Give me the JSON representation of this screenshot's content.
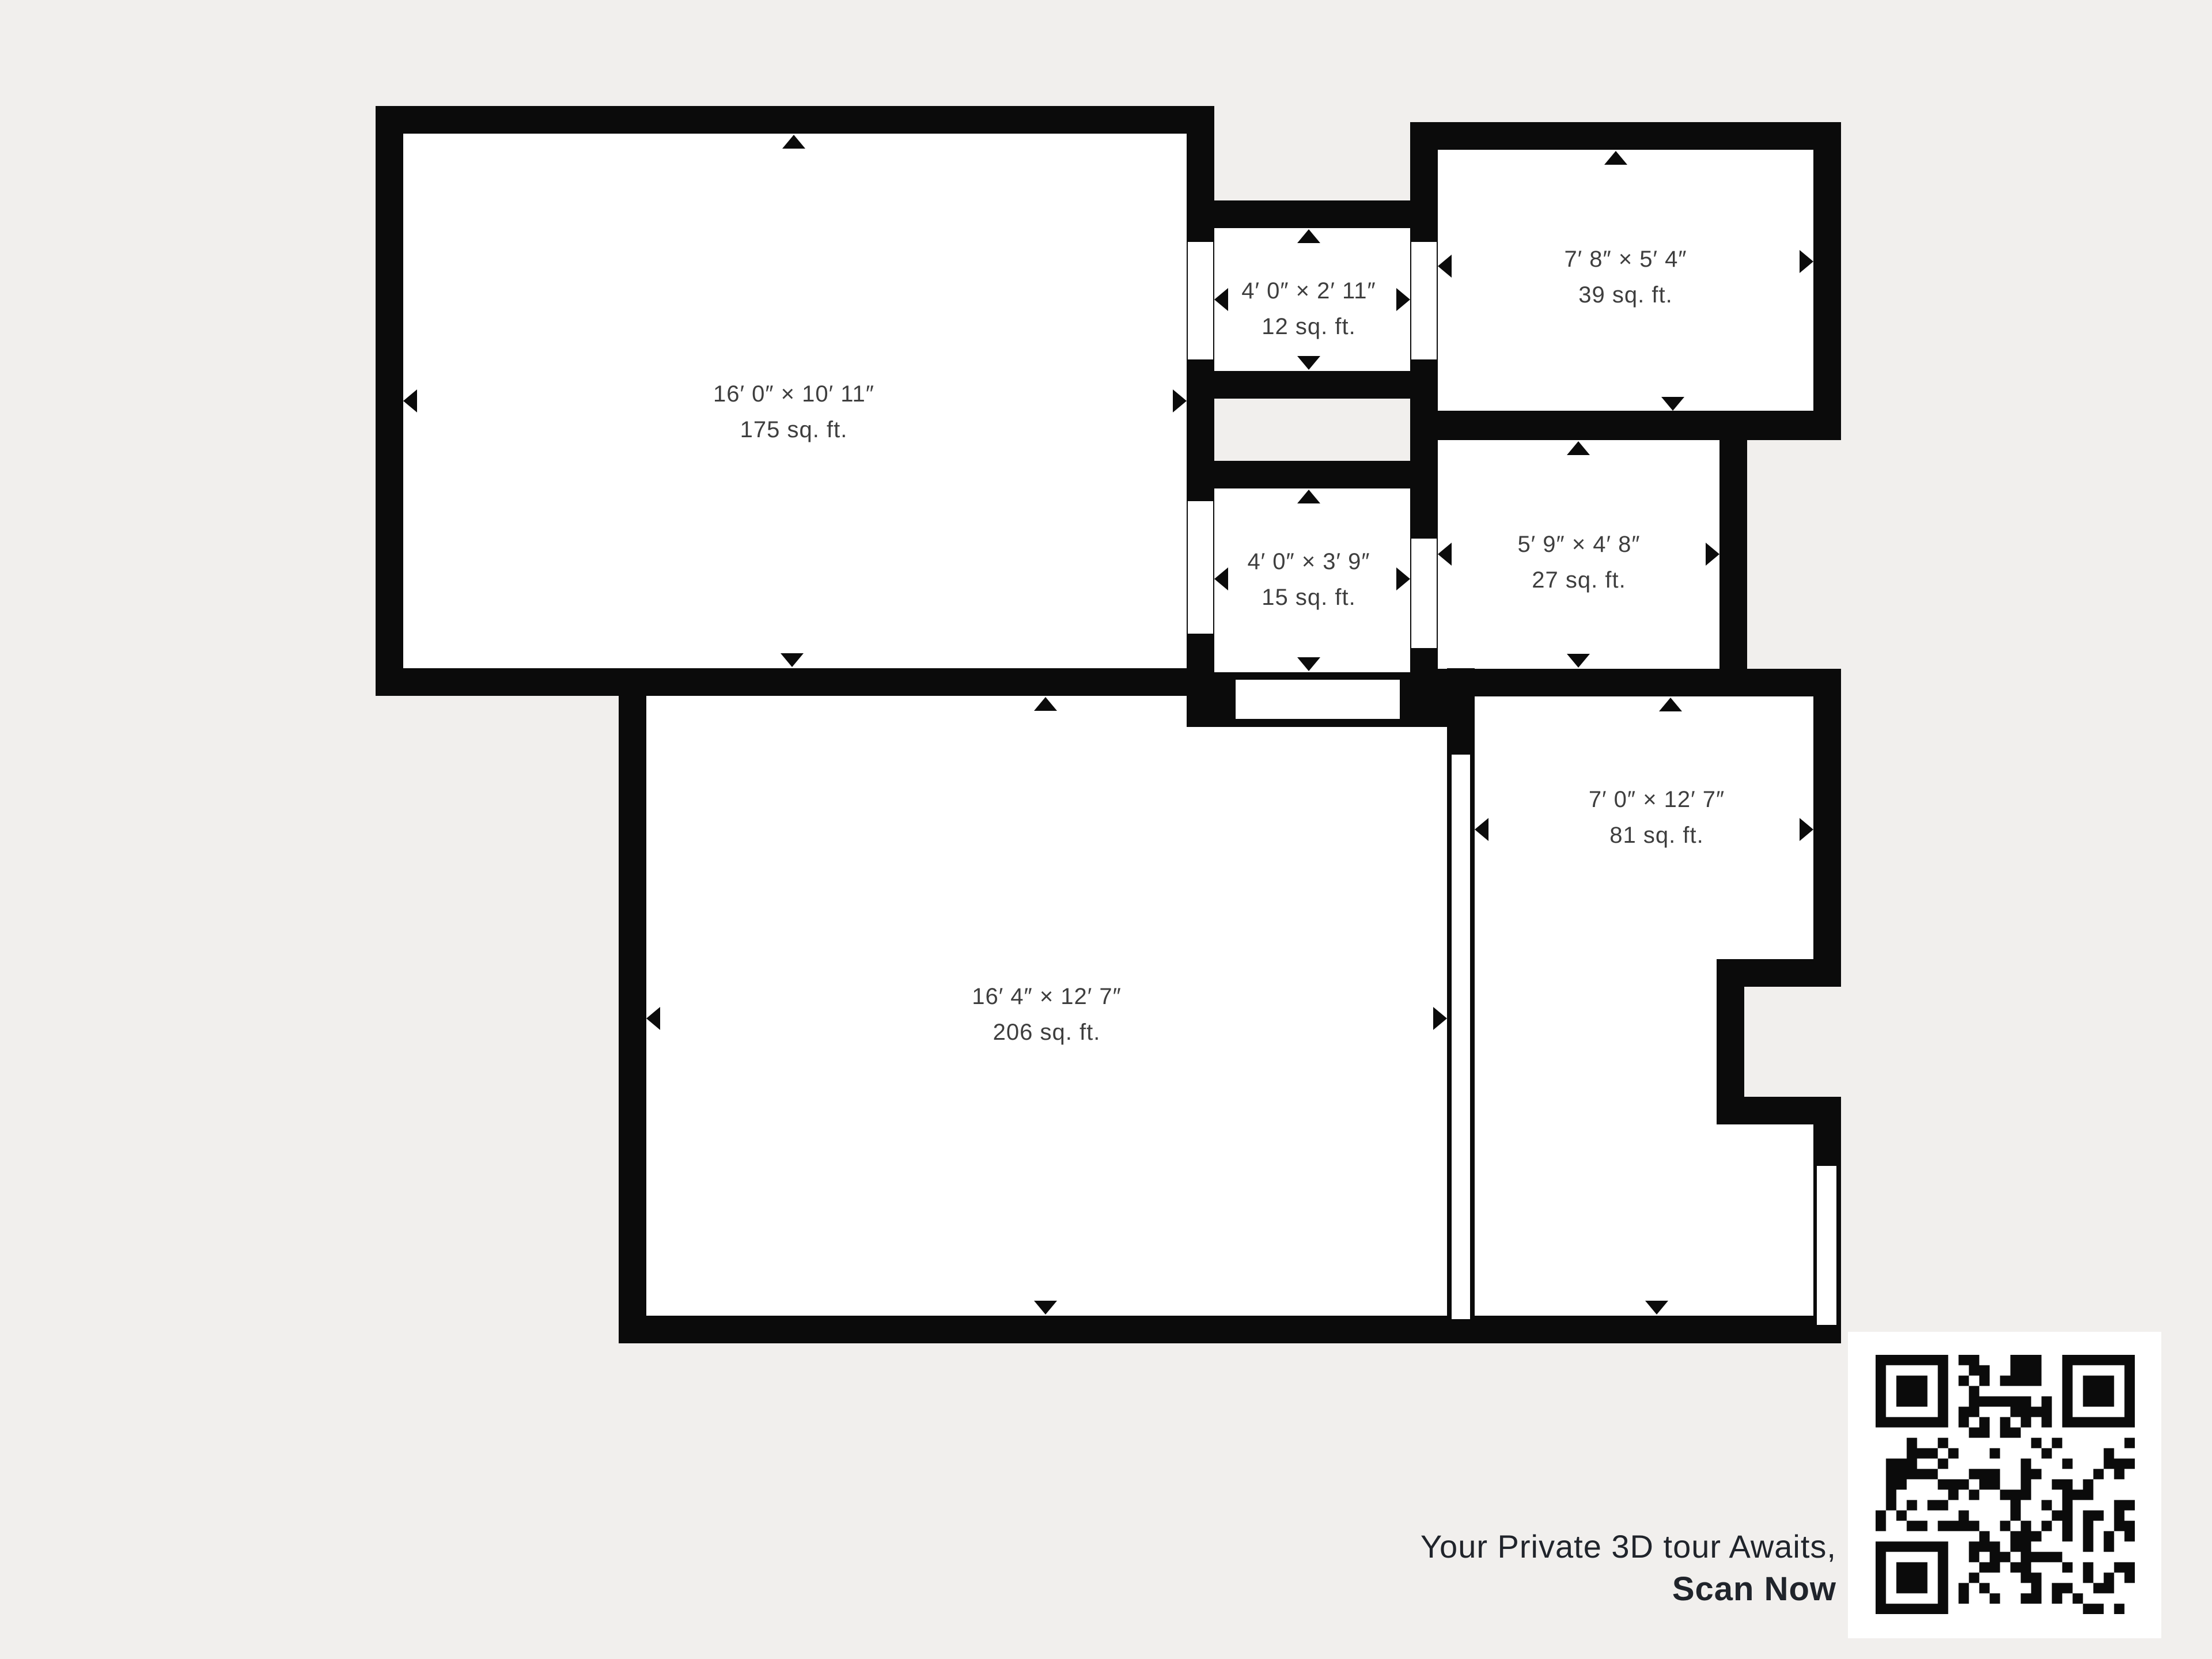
{
  "page": {
    "background": "#f1efed"
  },
  "floorplan": {
    "wall_color": "#0b0b0b",
    "room_fill": "#ffffff",
    "label_color": "#3e3e3e",
    "rooms": [
      {
        "id": "room-175",
        "dimensions": "16′ 0″ × 10′ 11″",
        "area": "175 sq. ft."
      },
      {
        "id": "room-12",
        "dimensions": "4′ 0″ × 2′ 11″",
        "area": "12 sq. ft."
      },
      {
        "id": "room-39",
        "dimensions": "7′ 8″ × 5′ 4″",
        "area": "39 sq. ft."
      },
      {
        "id": "room-15",
        "dimensions": "4′ 0″ × 3′ 9″",
        "area": "15 sq. ft."
      },
      {
        "id": "room-27",
        "dimensions": "5′ 9″ × 4′ 8″",
        "area": "27 sq. ft."
      },
      {
        "id": "room-206",
        "dimensions": "16′ 4″ × 12′ 7″",
        "area": "206 sq. ft."
      },
      {
        "id": "room-81",
        "dimensions": "7′ 0″ × 12′ 7″",
        "area": "81 sq. ft."
      }
    ]
  },
  "footer": {
    "line1": "Your Private 3D tour Awaits,",
    "line2": "Scan Now"
  }
}
